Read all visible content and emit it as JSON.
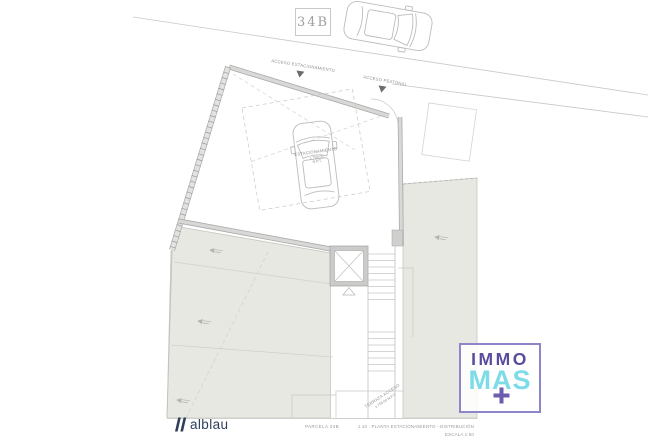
{
  "plan": {
    "unit_label": "34B",
    "annotations": {
      "acceso_estacionamiento": "ACCESO ESTACIONAMIENTO",
      "acceso_peatonal": "ACCESO PEATONAL",
      "estacionamiento": "ESTACIONAMIENTO",
      "estacionamiento_level": "± 758.00",
      "estacionamiento_level2": "N.P.T.",
      "terraza": "TERRAZA ACCESO",
      "terraza_level": "± 758.00 N.P.T."
    },
    "footer": {
      "parcel_caption": "PARCELA 34B",
      "sheet_title": "1.10 . PLANTA ESTACIONAMIENTO - DISTRIBUCIÓN",
      "scale": "ESCALA 1:50"
    },
    "branding": {
      "architect": "alblau",
      "agency_top": "IMMO",
      "agency_bottom": "MAS",
      "agency_plus": "+"
    },
    "colors": {
      "line_gray": "#c8c8c6",
      "wall_fill": "#d6d6d4",
      "wall_edge": "#ababab",
      "green_area": "#e6e8e1",
      "annotation_text": "#8f8f8f",
      "architect_navy": "#2e3d5a",
      "agency_purple": "#5b4b9d",
      "agency_border": "#8d86c8",
      "agency_cyan": "#7edce8"
    }
  }
}
